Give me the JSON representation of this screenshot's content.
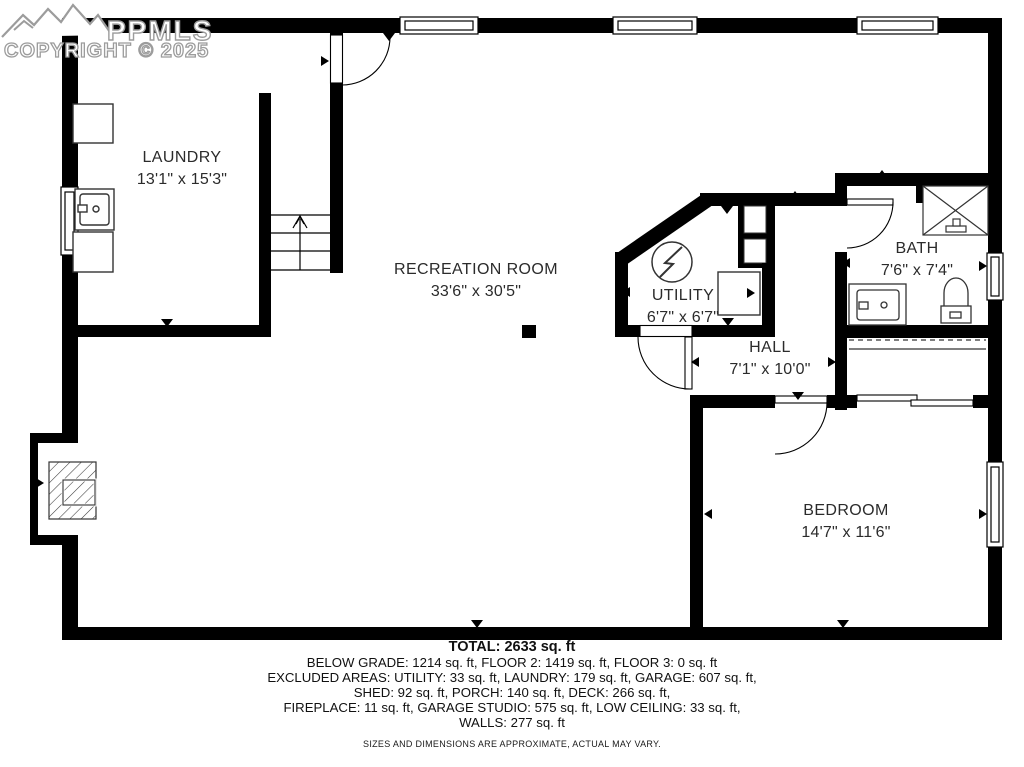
{
  "watermark": {
    "logo_text": "PPMLS",
    "copyright": "COPYRIGHT © 2025"
  },
  "rooms": [
    {
      "id": "laundry",
      "name": "LAUNDRY",
      "dims": "13'1\" x 15'3\""
    },
    {
      "id": "recreation",
      "name": "RECREATION ROOM",
      "dims": "33'6\" x 30'5\""
    },
    {
      "id": "utility",
      "name": "UTILITY",
      "dims": "6'7\" x 6'7\""
    },
    {
      "id": "hall",
      "name": "HALL",
      "dims": "7'1\" x 10'0\""
    },
    {
      "id": "bath",
      "name": "BATH",
      "dims": "7'6\" x 7'4\""
    },
    {
      "id": "bedroom",
      "name": "BEDROOM",
      "dims": "14'7\" x 11'6\""
    }
  ],
  "summary": {
    "total": "TOTAL: 2633 sq. ft",
    "lines": [
      "BELOW GRADE: 1214 sq. ft, FLOOR 2: 1419 sq. ft, FLOOR 3: 0 sq. ft",
      "EXCLUDED AREAS: UTILITY: 33 sq. ft, LAUNDRY: 179 sq. ft, GARAGE: 607 sq. ft,",
      "SHED: 92 sq. ft, PORCH: 140 sq. ft, DECK: 266 sq. ft,",
      "FIREPLACE: 11 sq. ft, GARAGE STUDIO: 575 sq. ft, LOW CEILING: 33 sq. ft,",
      "WALLS: 277 sq. ft"
    ],
    "disclaimer": "SIZES AND DIMENSIONS ARE APPROXIMATE, ACTUAL MAY VARY."
  },
  "colors": {
    "wall": "#000000",
    "text": "#2b2b2b",
    "watermark_outline": "#9c9c9c",
    "background": "#ffffff"
  }
}
